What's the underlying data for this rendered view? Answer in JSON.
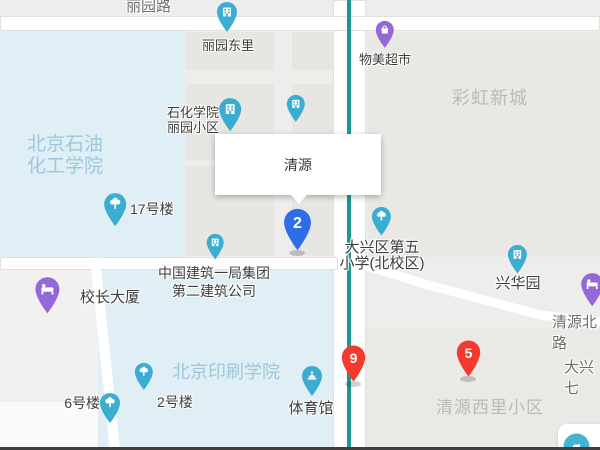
{
  "map": {
    "popup": {
      "title": "清源"
    },
    "colors": {
      "background": "#efedeb",
      "campus_fill": "#e0eef5",
      "building_fill": "#e8e6e3",
      "road_white": "#ffffff",
      "road_line_teal": "#1d9795",
      "poi_blue": "#3aadd0",
      "poi_purple": "#9468d8",
      "marker_blue": "#2e6de7",
      "marker_red": "#f23a2e",
      "campus_text": "#9cc8db",
      "district_text": "#bcbab7"
    },
    "area_labels": [
      {
        "name": "beijing-petroleum-institute",
        "text": "北京石油\n化工学院",
        "x": 27,
        "y": 134,
        "size": 19,
        "lh": 22,
        "cls": "lbl-campus"
      },
      {
        "name": "rainbow-new-town",
        "text": "彩虹新城",
        "x": 452,
        "y": 88,
        "size": 18,
        "lh": 20,
        "cls": "lbl-district"
      },
      {
        "name": "beijing-institute-of-printing",
        "text": "北京印刷学院",
        "x": 172,
        "y": 362,
        "size": 18,
        "lh": 20,
        "cls": "lbl-campus"
      },
      {
        "name": "qingyuan-xili-community",
        "text": "清源西里小区",
        "x": 436,
        "y": 398,
        "size": 17,
        "lh": 19,
        "cls": "lbl-district"
      }
    ],
    "road_labels": [
      {
        "name": "liyuan-road",
        "text": "丽园路",
        "x": 126,
        "y": -5,
        "size": 15
      },
      {
        "name": "qingyuan-north-road",
        "text": "清源北路",
        "x": 552,
        "y": 311,
        "size": 15
      },
      {
        "name": "daxing-seven",
        "text": "大兴七",
        "x": 564,
        "y": 356,
        "size": 15
      }
    ],
    "pois": [
      {
        "name": "liyuan-dongli",
        "icon": "building-icon",
        "color": "blue",
        "pin": {
          "x": 227,
          "y": 33,
          "r": 10
        },
        "label": {
          "text": "丽园东里",
          "x": 228,
          "y": 38,
          "size": 13,
          "align": "center"
        }
      },
      {
        "name": "shihua-liyuan-community",
        "icon": "building-icon",
        "color": "blue",
        "pin": {
          "x": 230,
          "y": 132,
          "r": 11
        },
        "label": {
          "text": "石化学院\n丽园小区",
          "x": 219,
          "y": 106,
          "size": 13,
          "lh": 14.5,
          "align": "right"
        }
      },
      {
        "name": "hidden-poi",
        "icon": "building-icon",
        "color": "blue",
        "pin": {
          "x": 296,
          "y": 123,
          "r": 9
        }
      },
      {
        "name": "wumei-supermarket",
        "icon": "shopping-icon",
        "color": "purple",
        "pin": {
          "x": 385,
          "y": 49,
          "r": 9
        },
        "label": {
          "text": "物美超市",
          "x": 385,
          "y": 52,
          "size": 13,
          "align": "center"
        }
      },
      {
        "name": "building-17",
        "icon": "tree-icon",
        "color": "blue",
        "pin": {
          "x": 115,
          "y": 227,
          "r": 11
        },
        "label": {
          "text": "17号楼",
          "x": 130,
          "y": 201,
          "size": 14,
          "align": "left"
        }
      },
      {
        "name": "china-construction-first-group",
        "icon": "building-icon",
        "color": "blue",
        "pin": {
          "x": 215,
          "y": 260,
          "r": 8.5
        },
        "label": {
          "text": "中国建筑一局集团\n第二建筑公司",
          "x": 214,
          "y": 265,
          "size": 14,
          "lh": 17.5,
          "align": "center"
        }
      },
      {
        "name": "principal-tower",
        "icon": "bed-icon",
        "color": "purple",
        "pin": {
          "x": 47,
          "y": 314,
          "r": 12
        },
        "label": {
          "text": "校长大厦",
          "x": 80,
          "y": 289,
          "size": 15,
          "align": "left"
        }
      },
      {
        "name": "daxing-no5-primary-school",
        "icon": "tree-icon",
        "color": "blue",
        "pin": {
          "x": 381,
          "y": 236,
          "r": 9.5
        },
        "label": {
          "text": "大兴区第五\n小学(北校区)",
          "x": 382,
          "y": 240,
          "size": 15,
          "lh": 16,
          "align": "center"
        }
      },
      {
        "name": "xinghuayuan",
        "icon": "building-icon",
        "color": "blue",
        "pin": {
          "x": 517,
          "y": 274,
          "r": 9.5
        },
        "label": {
          "text": "兴华园",
          "x": 518,
          "y": 275,
          "size": 15,
          "align": "center"
        }
      },
      {
        "name": "gymnasium",
        "icon": "stadium-icon",
        "color": "blue",
        "pin": {
          "x": 312,
          "y": 397,
          "r": 10
        },
        "label": {
          "text": "体育馆",
          "x": 311,
          "y": 400,
          "size": 15,
          "align": "center"
        }
      },
      {
        "name": "building-6",
        "icon": "tree-icon",
        "color": "blue",
        "pin": {
          "x": 110,
          "y": 424,
          "r": 10
        },
        "label": {
          "text": "6号楼",
          "x": 100,
          "y": 395,
          "size": 14,
          "align": "right"
        }
      },
      {
        "name": "building-2",
        "icon": "tree-icon",
        "color": "blue",
        "pin": {
          "x": 144,
          "y": 391,
          "r": 9
        },
        "label": {
          "text": "2号楼",
          "x": 157,
          "y": 394,
          "size": 14,
          "align": "left"
        }
      },
      {
        "name": "hotel-east",
        "icon": "bed-icon",
        "color": "purple",
        "pin": {
          "x": 592,
          "y": 307,
          "r": 11
        }
      }
    ],
    "markers": [
      {
        "name": "marker-2",
        "number": "2",
        "color": "marker_blue",
        "tip_x": 297,
        "tip_y": 252,
        "w": 31,
        "h": 45
      },
      {
        "name": "marker-9",
        "number": "9",
        "color": "marker_red",
        "tip_x": 353,
        "tip_y": 383,
        "w": 27,
        "h": 39
      },
      {
        "name": "marker-5",
        "number": "5",
        "color": "marker_red",
        "tip_x": 468,
        "tip_y": 378,
        "w": 27,
        "h": 39
      }
    ],
    "corner_card_icon": "bird-icon"
  }
}
